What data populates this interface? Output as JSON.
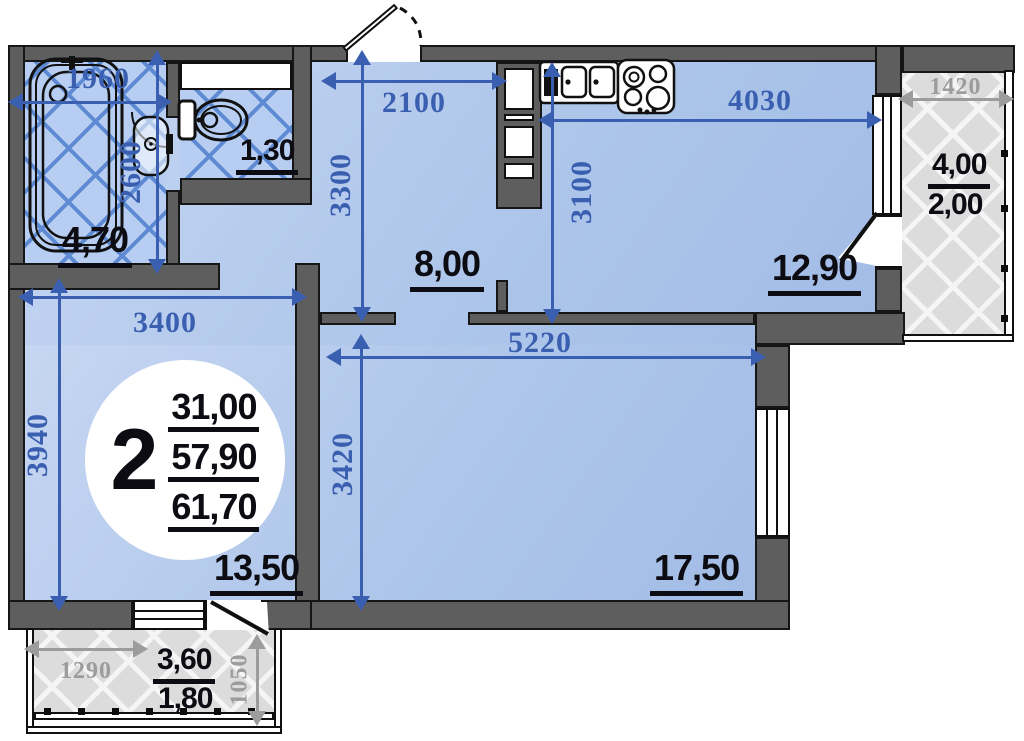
{
  "badge": {
    "room_count": "2",
    "living_area": "31,00",
    "apartment_area": "57,90",
    "total_area": "61,70"
  },
  "dimensions": {
    "bathroom_width": "1960",
    "bathroom_depth": "2600",
    "hallway_width": "2100",
    "hallway_depth": "3300",
    "kitchen_width": "4030",
    "kitchen_depth": "3100",
    "right_balcony_width": "1420",
    "bedroom_width": "3400",
    "bedroom_depth": "3940",
    "living_width": "5220",
    "living_depth": "3420",
    "bottom_balcony_width": "1290",
    "bottom_balcony_depth": "1050"
  },
  "areas": {
    "bathroom": "4,70",
    "toilet": "1,30",
    "hallway": "8,00",
    "kitchen": "12,90",
    "right_balcony_full": "4,00",
    "right_balcony_reduced": "2,00",
    "bedroom": "13,50",
    "living_room": "17,50",
    "bottom_balcony_full": "3,60",
    "bottom_balcony_reduced": "1,80"
  },
  "colors": {
    "wall": "#5e5e5e",
    "room_fill": "#aec6ea",
    "tile_line": "#5d8ad2",
    "balcony_fill": "#dcdcdc",
    "dim_blue": "#3a5fb0",
    "dim_gray": "#9c9c9c",
    "label": "#0c0c12"
  }
}
